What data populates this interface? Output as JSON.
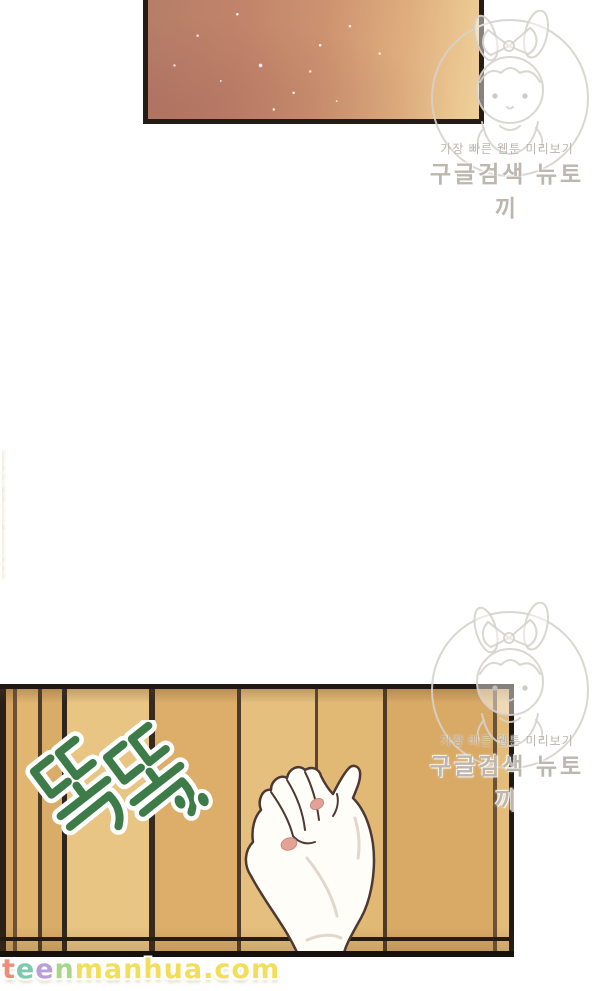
{
  "canvas": {
    "width": 600,
    "height": 991,
    "background": "#ffffff"
  },
  "top_panel": {
    "description_icon": "orange-glow-scene",
    "border_color": "#241c16",
    "gradient_colors": [
      "#b57e68",
      "#cd9370",
      "#ecc892"
    ],
    "speckle_color": "#ffffff"
  },
  "newtoki_watermark": {
    "mascot_icon": "rabbit-girl-mascot",
    "tagline": "가장 빠른 웹툰 미리보기",
    "brand": "구글검색 뉴토끼",
    "color": "#b2aaa2"
  },
  "door_panel": {
    "description_icon": "wooden-door-planks",
    "border_color": "#1f1813",
    "plank_light": "#e9c583",
    "plank_mid": "#e0b670",
    "plank_dark": "#d3a462",
    "groove_color": "#4c3a29"
  },
  "knock_sfx": {
    "text": "똑똑..",
    "color": "#3d7c49",
    "outline_color": "#ffffff"
  },
  "hand": {
    "description_icon": "knocking-hand",
    "skin_color": "#fffdf8",
    "outline_color": "#4d3833",
    "nail_color": "#e2a396"
  },
  "wordmark": {
    "text": "teenmanhua.com",
    "outline_color": "#ffffff",
    "letters": [
      {
        "ch": "t",
        "color": "#ee8e79"
      },
      {
        "ch": "e",
        "color": "#7cc9b0"
      },
      {
        "ch": "e",
        "color": "#bb9ed8"
      },
      {
        "ch": "n",
        "color": "#a6d689"
      },
      {
        "ch": "m",
        "color": "#f2de5a"
      },
      {
        "ch": "a",
        "color": "#f2de5a"
      },
      {
        "ch": "n",
        "color": "#f2de5a"
      },
      {
        "ch": "h",
        "color": "#f2de5a"
      },
      {
        "ch": "u",
        "color": "#f2de5a"
      },
      {
        "ch": "a",
        "color": "#f2de5a"
      },
      {
        "ch": ".",
        "color": "#f2de5a"
      },
      {
        "ch": "c",
        "color": "#f2de5a"
      },
      {
        "ch": "o",
        "color": "#f2de5a"
      },
      {
        "ch": "m",
        "color": "#f2de5a"
      }
    ]
  }
}
